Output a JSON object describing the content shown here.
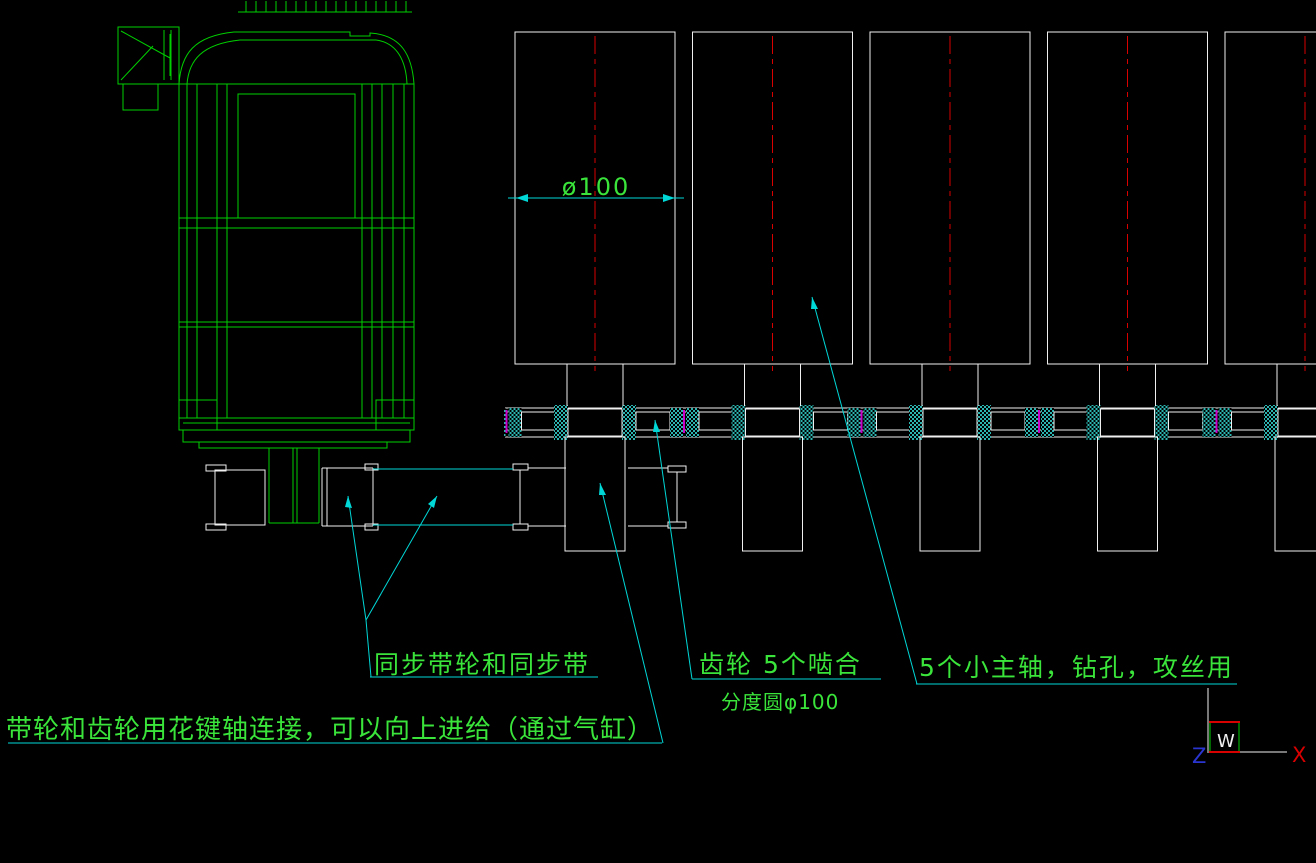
{
  "app": {
    "type": "cad-drawing-viewport"
  },
  "colors": {
    "background": "#000000",
    "green": "#00cf00",
    "text_green": "#3ae43a",
    "white": "#f0f0f0",
    "cyan": "#00d7d7",
    "hatch_cyan": "#2cb4b0",
    "red": "#d90000",
    "magenta": "#c800c8",
    "blue": "#2a35d0"
  },
  "dimension": {
    "label": "ø100"
  },
  "notes": {
    "sync_belt": "同步带轮和同步带",
    "gear_mesh": "齿轮 5个啮合",
    "pitch_circle": "分度圆φ100",
    "spindles": "5个小主轴，钻孔，攻丝用",
    "spline_shaft": "带轮和齿轮用花键轴连接，可以向上进给（通过气缸）"
  },
  "ucs": {
    "world": "W",
    "axis_x": "X",
    "axis_z": "Z"
  }
}
